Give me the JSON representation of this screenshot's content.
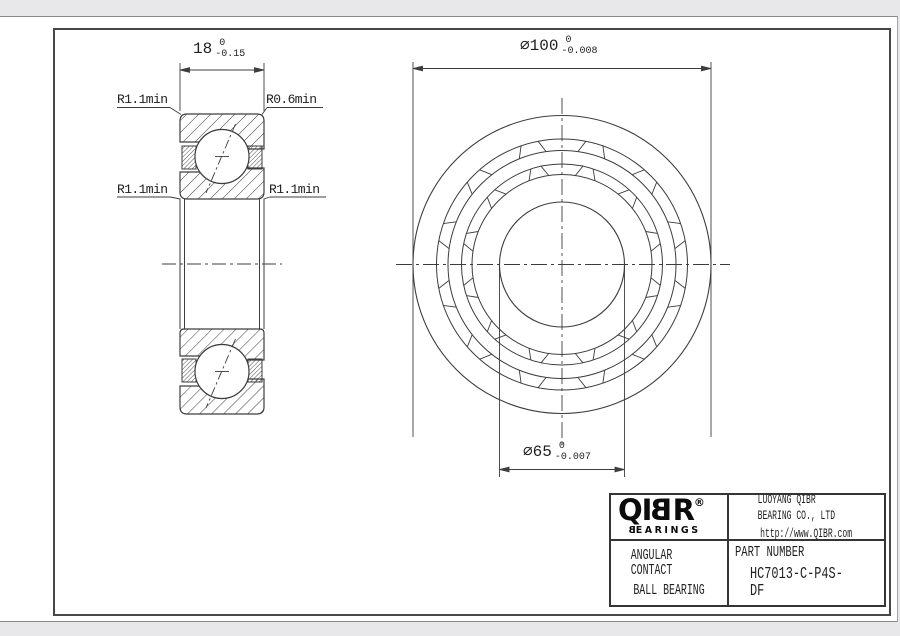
{
  "page": {
    "background": "#e8e8ea",
    "sheet": "#ffffff",
    "line_color": "#3d3d3d",
    "frame_color": "#474747",
    "text_color": "#1f1f1f"
  },
  "section_view": {
    "dim_width": {
      "value": "18",
      "tol_upper": "0",
      "tol_lower": "-0.15"
    },
    "radius_labels": {
      "top_left": "R1.1min",
      "top_right": "R0.6min",
      "mid_left": "R1.1min",
      "mid_right": "R1.1min"
    }
  },
  "front_view": {
    "dim_outer_diameter": {
      "symbol": "⌀",
      "value": "100",
      "tol_upper": "0",
      "tol_lower": "-0.008"
    },
    "dim_bore_diameter": {
      "symbol": "⌀",
      "value": "65",
      "tol_upper": "0",
      "tol_lower": "-0.007"
    }
  },
  "title_block": {
    "logo": {
      "q": "Q",
      "i": "I",
      "b": "B",
      "r": "R",
      "registered": "®",
      "tagline_b": "B",
      "tagline_rest": "EARINGS"
    },
    "company_name": "LUOYANG QIBR BEARING CO., LTD",
    "website": "http://www.QIBR.com",
    "product_line1": "ANGULAR CONTACT",
    "product_line2": "BALL BEARING",
    "part_number_label": "PART NUMBER",
    "part_number": "HC7013-C-P4S-DF"
  }
}
